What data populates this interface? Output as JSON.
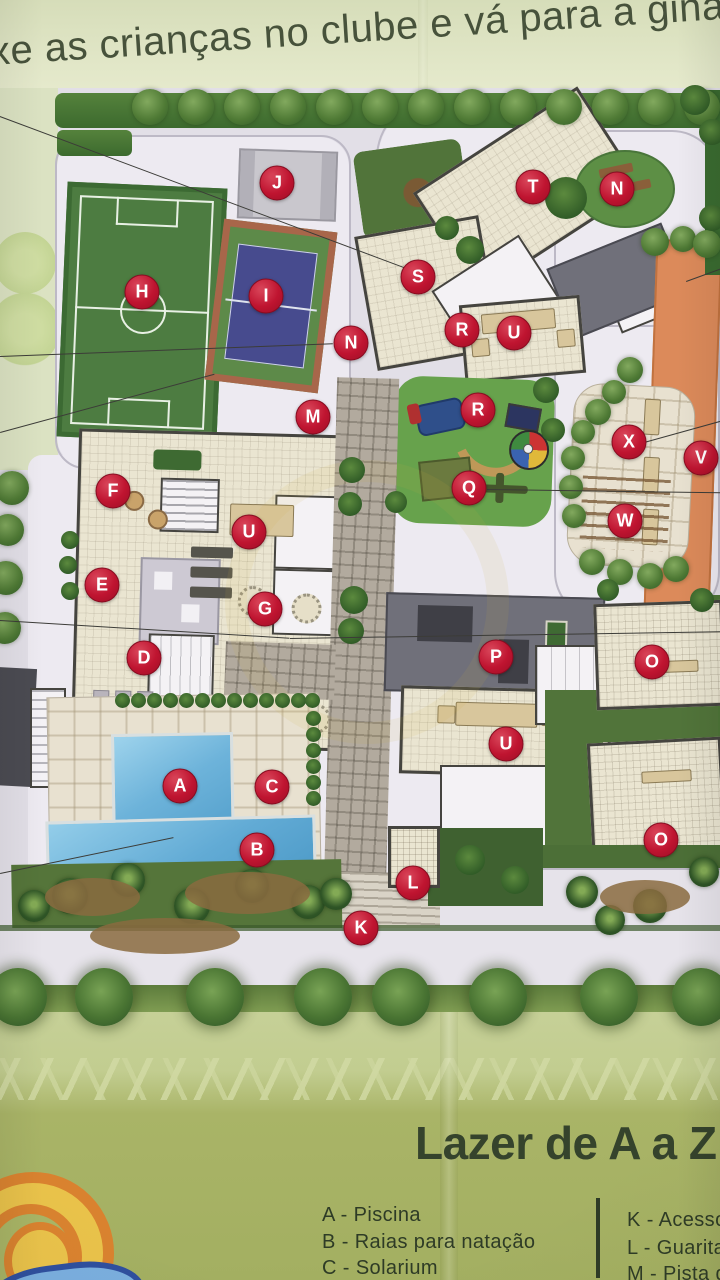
{
  "headline": "xe as crianças no clube e vá para a ginást",
  "map": {
    "title": "site-plan",
    "markers": [
      {
        "letter": "H",
        "x": 142,
        "y": 292
      },
      {
        "letter": "I",
        "x": 266,
        "y": 296
      },
      {
        "letter": "J",
        "x": 277,
        "y": 183
      },
      {
        "letter": "T",
        "x": 533,
        "y": 187
      },
      {
        "letter": "N",
        "x": 617,
        "y": 189
      },
      {
        "letter": "S",
        "x": 418,
        "y": 277
      },
      {
        "letter": "R",
        "x": 462,
        "y": 330
      },
      {
        "letter": "U",
        "x": 514,
        "y": 333
      },
      {
        "letter": "N",
        "x": 351,
        "y": 343
      },
      {
        "letter": "M",
        "x": 313,
        "y": 417
      },
      {
        "letter": "R",
        "x": 478,
        "y": 410
      },
      {
        "letter": "Q",
        "x": 469,
        "y": 488
      },
      {
        "letter": "X",
        "x": 629,
        "y": 442
      },
      {
        "letter": "V",
        "x": 701,
        "y": 458
      },
      {
        "letter": "W",
        "x": 625,
        "y": 521
      },
      {
        "letter": "F",
        "x": 113,
        "y": 491
      },
      {
        "letter": "U",
        "x": 249,
        "y": 532
      },
      {
        "letter": "E",
        "x": 102,
        "y": 585
      },
      {
        "letter": "G",
        "x": 265,
        "y": 609
      },
      {
        "letter": "D",
        "x": 144,
        "y": 658
      },
      {
        "letter": "P",
        "x": 496,
        "y": 657
      },
      {
        "letter": "O",
        "x": 652,
        "y": 662
      },
      {
        "letter": "U",
        "x": 506,
        "y": 744
      },
      {
        "letter": "A",
        "x": 180,
        "y": 786
      },
      {
        "letter": "C",
        "x": 272,
        "y": 787
      },
      {
        "letter": "B",
        "x": 257,
        "y": 850
      },
      {
        "letter": "O",
        "x": 661,
        "y": 840
      },
      {
        "letter": "L",
        "x": 413,
        "y": 883
      },
      {
        "letter": "K",
        "x": 361,
        "y": 928
      }
    ]
  },
  "legend": {
    "title": "Lazer de A a Z pa",
    "left": [
      {
        "key": "A",
        "text": "A - Piscina"
      },
      {
        "key": "B",
        "text": "B - Raias para natação"
      },
      {
        "key": "C",
        "text": "C - Solarium"
      }
    ],
    "right": [
      {
        "key": "K",
        "text": "K - Acesso c"
      },
      {
        "key": "L",
        "text": "L - Guarita c"
      },
      {
        "key": "M",
        "text": "M - Pista de"
      }
    ]
  },
  "logo": {
    "name": "sun-wave-logo"
  },
  "colors": {
    "marker_red": "#bf1430",
    "page_green_light": "#c2cd90",
    "page_green_dark": "#a3af61",
    "road": "#e2dfe7",
    "field_green": "#4d7c41",
    "court_blue": "#474b8e",
    "track_orange": "#dc8a5a",
    "pool_blue": "#6db3da",
    "text_dark_green": "#35432c"
  }
}
